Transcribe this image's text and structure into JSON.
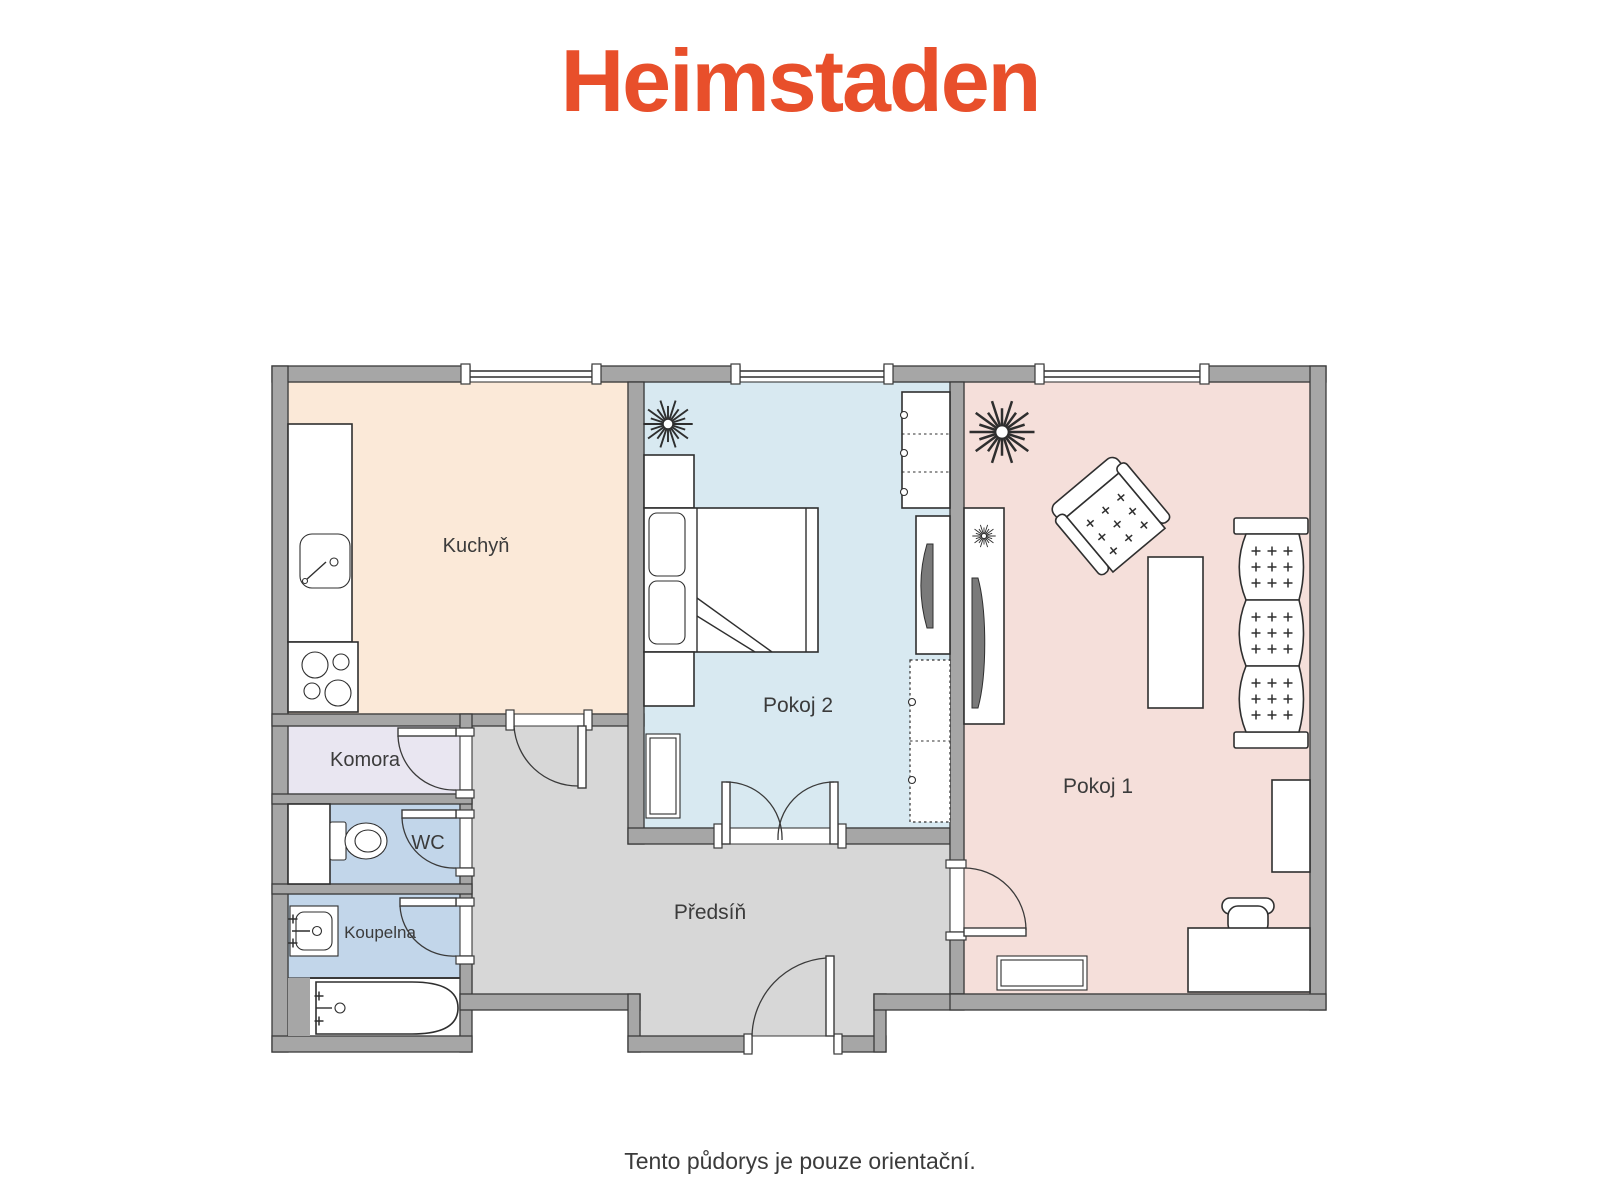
{
  "logo": {
    "text": "Heimstaden"
  },
  "caption": "Tento půdorys je pouze orientační.",
  "rooms": {
    "kuchyn": {
      "label": "Kuchyň"
    },
    "pokoj2": {
      "label": "Pokoj 2"
    },
    "pokoj1": {
      "label": "Pokoj 1"
    },
    "komora": {
      "label": "Komora"
    },
    "wc": {
      "label": "WC"
    },
    "koupelna": {
      "label": "Koupelna"
    },
    "predsin": {
      "label": "Předsíň"
    }
  },
  "colors": {
    "logo": "#E84F2B",
    "wall": "#A6A6A6",
    "line": "#3A3A3A",
    "kitchen": "#FBE9D8",
    "room2": "#D8E9F1",
    "room1": "#F5DFDA",
    "pantry": "#E9E6F1",
    "bath": "#C2D6EA",
    "hallway": "#D7D7D7",
    "furniture_fill": "#FFFFFF",
    "tv": "#7A7A7A",
    "text": "#3B3B3B"
  },
  "icons": [
    "plant-icon",
    "sink-icon",
    "stove-icon",
    "toilet-icon",
    "washbasin-icon",
    "bathtub-icon",
    "bed-icon",
    "nightstand-icon",
    "wardrobe-icon",
    "tv-icon",
    "radiator-icon",
    "armchair-icon",
    "coffee-table-icon",
    "sofa-icon",
    "desk-icon",
    "chair-icon",
    "cabinet-icon",
    "door-icon",
    "window-icon"
  ]
}
